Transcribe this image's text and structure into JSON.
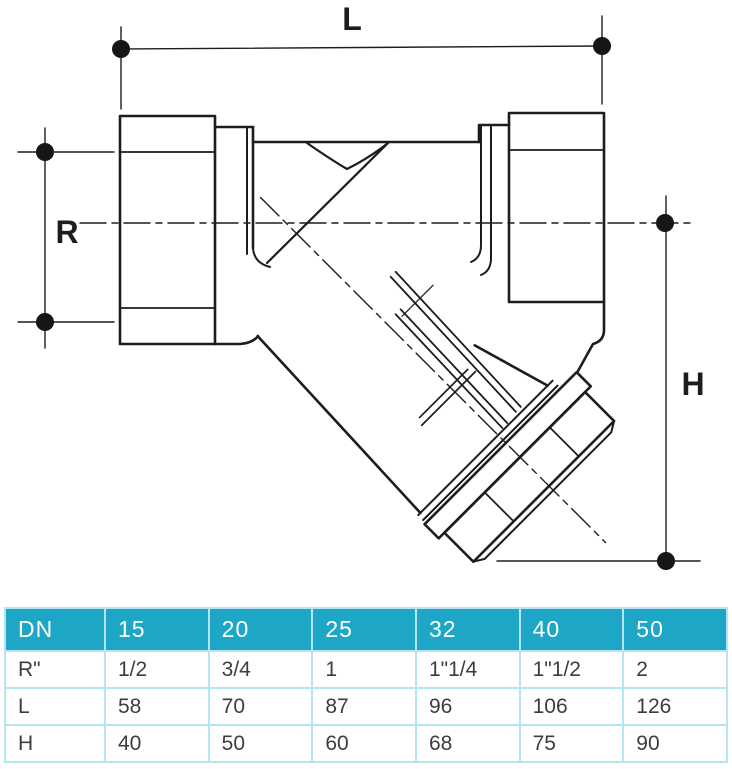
{
  "theme": {
    "header-bg": "#1da6c6",
    "table-border": "#b7e4f2",
    "header-text": "#ffffff",
    "body-text": "#3d3d3d",
    "line": "#1d1d1d",
    "page-bg": "#ffffff"
  },
  "diagram": {
    "type": "technical-drawing-y-strainer",
    "labels": {
      "length": "L",
      "thread": "R",
      "height": "H"
    }
  },
  "table": {
    "columns": [
      "DN",
      "15",
      "20",
      "25",
      "32",
      "40",
      "50"
    ],
    "rows": [
      {
        "label": "R\"",
        "values": [
          "1/2",
          "3/4",
          "1",
          "1\"1/4",
          "1\"1/2",
          "2"
        ]
      },
      {
        "label": "L",
        "values": [
          "58",
          "70",
          "87",
          "96",
          "106",
          "126"
        ]
      },
      {
        "label": "H",
        "values": [
          "40",
          "50",
          "60",
          "68",
          "75",
          "90"
        ]
      }
    ]
  }
}
